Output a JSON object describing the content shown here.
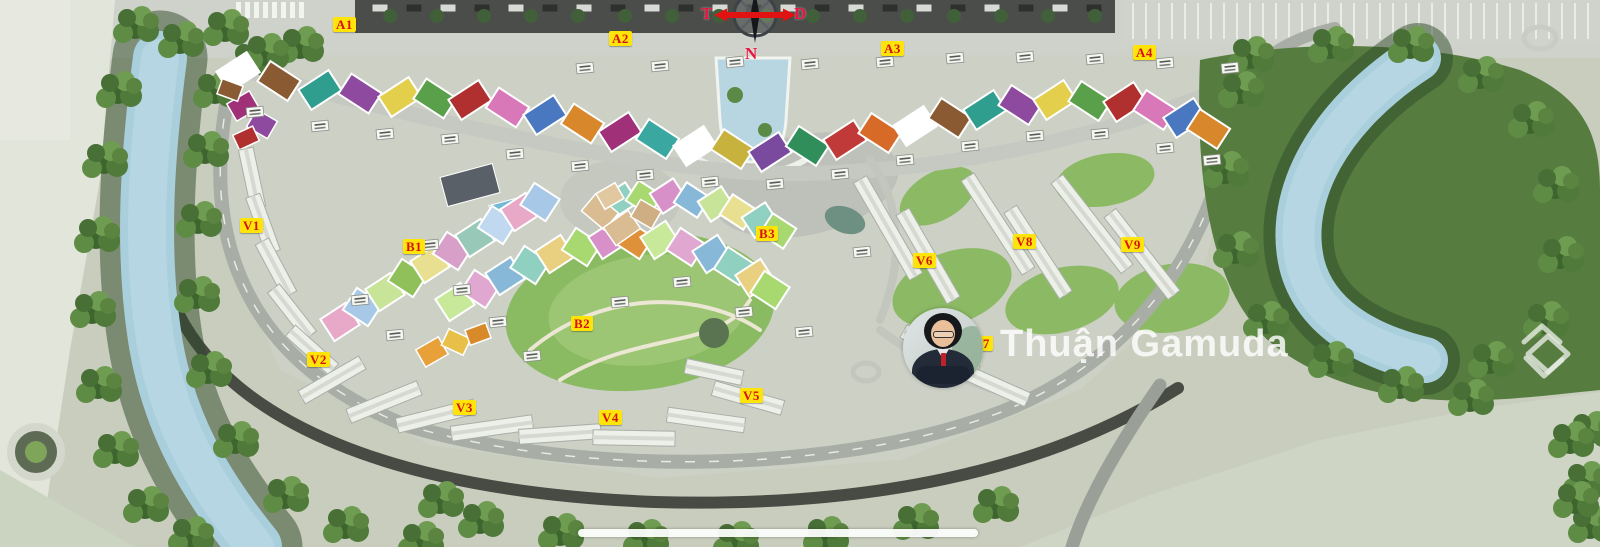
{
  "compass": {
    "west": "T",
    "east": "D",
    "south": "N"
  },
  "watermark": {
    "name": "Thuận Gamuda"
  },
  "zones": [
    {
      "id": "A1",
      "label": "A1",
      "x": 333,
      "y": 17
    },
    {
      "id": "A2",
      "label": "A2",
      "x": 609,
      "y": 31
    },
    {
      "id": "A3",
      "label": "A3",
      "x": 881,
      "y": 41
    },
    {
      "id": "A4",
      "label": "A4",
      "x": 1133,
      "y": 45
    },
    {
      "id": "B1",
      "label": "B1",
      "x": 403,
      "y": 239
    },
    {
      "id": "B2",
      "label": "B2",
      "x": 571,
      "y": 316
    },
    {
      "id": "B3",
      "label": "B3",
      "x": 756,
      "y": 226
    },
    {
      "id": "V1",
      "label": "V1",
      "x": 240,
      "y": 218
    },
    {
      "id": "V2",
      "label": "V2",
      "x": 307,
      "y": 352
    },
    {
      "id": "V3",
      "label": "V3",
      "x": 453,
      "y": 400
    },
    {
      "id": "V4",
      "label": "V4",
      "x": 599,
      "y": 410
    },
    {
      "id": "V5",
      "label": "V5",
      "x": 740,
      "y": 388
    },
    {
      "id": "V6",
      "label": "V6",
      "x": 913,
      "y": 253
    },
    {
      "id": "V7",
      "label": "V7",
      "x": 970,
      "y": 336
    },
    {
      "id": "V8",
      "label": "V8",
      "x": 1013,
      "y": 234
    },
    {
      "id": "V9",
      "label": "V9",
      "x": 1121,
      "y": 237
    }
  ],
  "style": {
    "zone_label_bg": "#ffe409",
    "zone_label_text": "#d61111",
    "compass_letter_color": "#e81540",
    "compass_arrow_color": "#e01212",
    "river_color": "#aacfdc",
    "forest_color": "#4f7a3a"
  }
}
